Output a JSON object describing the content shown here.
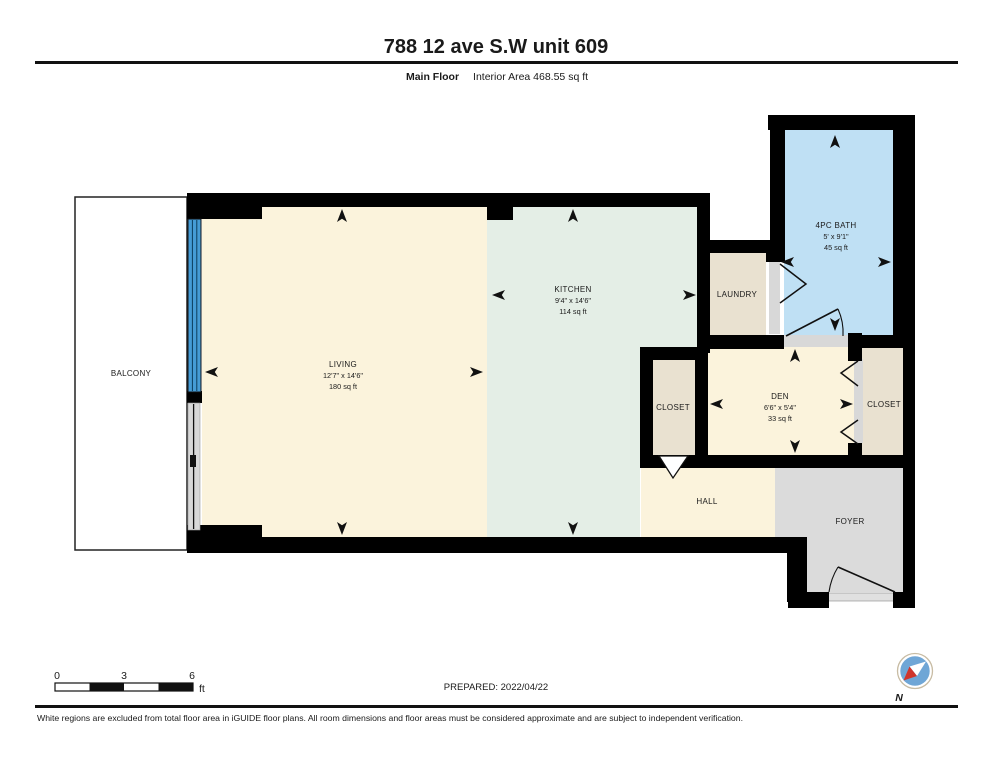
{
  "header": {
    "title": "788 12 ave S.W unit 609",
    "floor_label": "Main Floor",
    "area_label": "Interior Area 468.55 sq ft"
  },
  "rooms": {
    "balcony": {
      "name": "BALCONY"
    },
    "living": {
      "name": "LIVING",
      "dims": "12'7\" x 14'6\"",
      "area": "180 sq ft"
    },
    "kitchen": {
      "name": "KITCHEN",
      "dims": "9'4\" x 14'6\"",
      "area": "114 sq ft"
    },
    "laundry": {
      "name": "LAUNDRY"
    },
    "bath": {
      "name": "4PC BATH",
      "dims": "5' x 9'1\"",
      "area": "45 sq ft"
    },
    "closet_left": {
      "name": "CLOSET"
    },
    "den": {
      "name": "DEN",
      "dims": "6'6\" x 5'4\"",
      "area": "33 sq ft"
    },
    "closet_right": {
      "name": "CLOSET"
    },
    "hall": {
      "name": "HALL"
    },
    "foyer": {
      "name": "FOYER"
    }
  },
  "scale_bar": {
    "tick0": "0",
    "tick1": "3",
    "tick2": "6",
    "unit": "ft"
  },
  "prepared_label": "PREPARED: 2022/04/22",
  "compass": {
    "north_label": "N"
  },
  "footer": {
    "disclaimer": "White regions are excluded from total floor area in iGUIDE floor plans. All room dimensions and floor areas must be considered approximate and are subject to independent verification."
  },
  "colors": {
    "wall": "#000000",
    "room_living": "#FBF3DC",
    "room_kitchen": "#E4EEE6",
    "room_bath": "#BFE0F4",
    "room_storage": "#E9E1D0",
    "room_foyer": "#DBDBDB",
    "window": "#459CD6",
    "door_track": "#D8D8D8",
    "compass_fill": "#6FA6D6",
    "compass_red": "#D0352C"
  }
}
